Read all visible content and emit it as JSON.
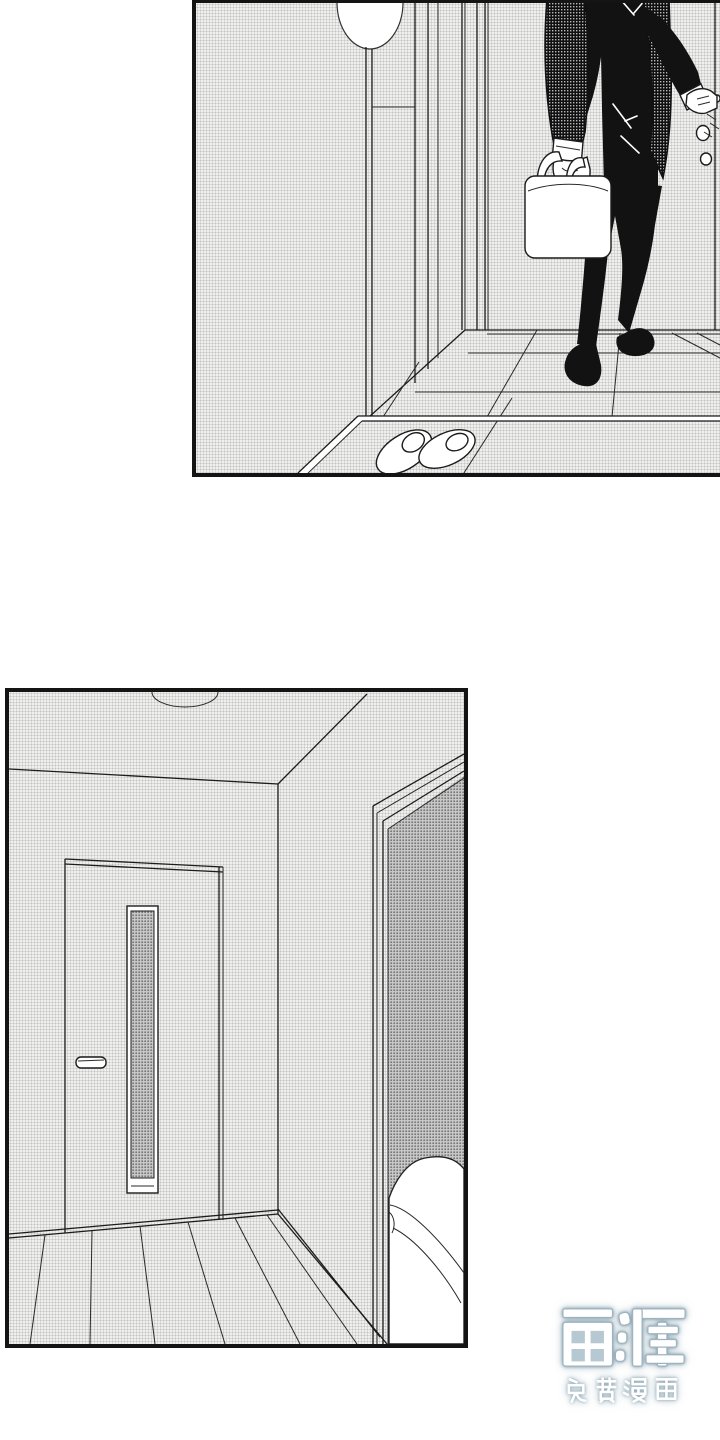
{
  "page": {
    "background": "#ffffff",
    "width": 720,
    "height": 1440
  },
  "panels": {
    "top": {
      "alt": "Manga panel: a man in a patterned tweed jacket holding a white handbag stands at the apartment entry door, hand on the door handle; a pair of slippers waits on the entryway floor."
    },
    "bottom": {
      "alt": "Manga panel: an empty room with a closed interior door with a narrow vertical window, and an open doorway on the right revealing the corner of a bed."
    }
  },
  "watermark": {
    "logo": "画涯",
    "tagline": "免费漫画",
    "glow_color": "#7d9baa",
    "core_color": "#ffffff"
  }
}
